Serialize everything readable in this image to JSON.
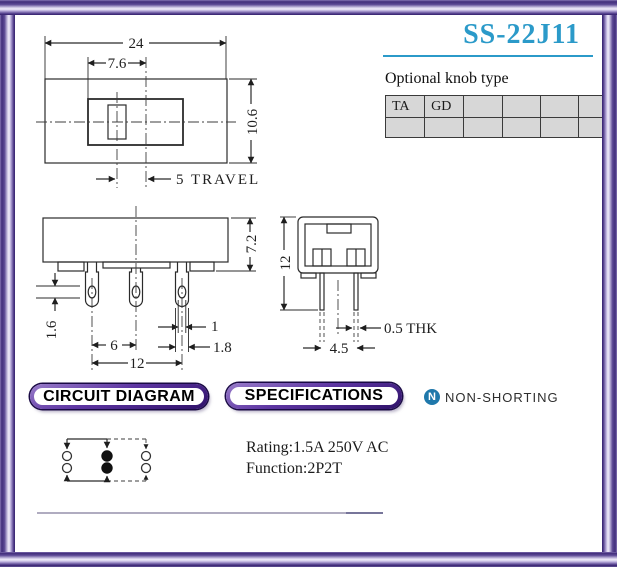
{
  "title": "SS-22J11",
  "colors": {
    "accent_blue": "#2b9ac9",
    "frame_purple": "#422e7c",
    "badge_purple": "#5d35a2",
    "icon_blue": "#1f78ab",
    "table_bg": "#d7d7d7"
  },
  "knob": {
    "label": "Optional knob type",
    "row1": [
      "TA",
      "GD",
      "",
      "",
      "",
      ""
    ],
    "row2": [
      "",
      "",
      "",
      "",
      "",
      ""
    ]
  },
  "badges": {
    "circuit": "CIRCUIT DIAGRAM",
    "specs": "SPECIFICATIONS"
  },
  "non_shorting": {
    "icon_letter": "N",
    "label": "NON-SHORTING"
  },
  "specs": {
    "rating": "Rating:1.5A 250V AC",
    "function": "Function:2P2T"
  },
  "top_view": {
    "width": "24",
    "window": "7.6",
    "height": "10.6",
    "travel": "5 TRAVEL"
  },
  "front_view": {
    "height": "7.2",
    "hole_height": "1.6",
    "pin_pitch": "6",
    "pin_span": "12",
    "hole_width": "1",
    "pin_width": "1.8"
  },
  "side_view": {
    "height": "12",
    "pin_gap": "4.5",
    "thickness": "0.5 THK"
  }
}
